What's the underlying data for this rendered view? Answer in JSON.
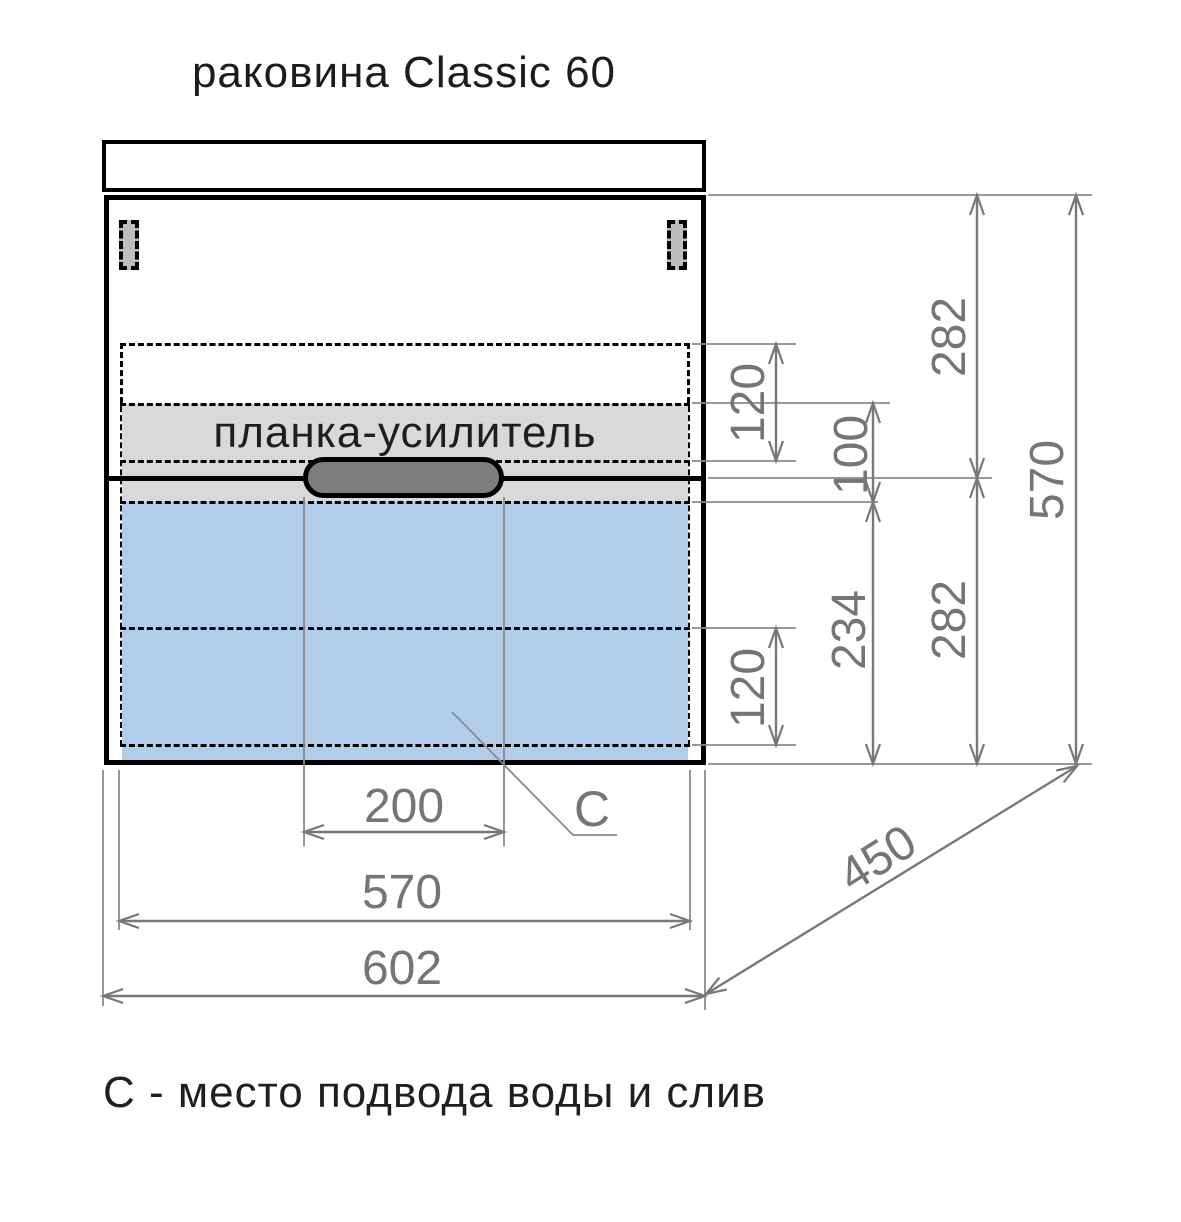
{
  "title": "раковина Classic 60",
  "caption": "С - место подвода воды и слив",
  "labels": {
    "reinforcement_bar": "планка-усилитель",
    "c_marker": "C"
  },
  "dimensions": {
    "overall_width": "602",
    "inner_width": "570",
    "handle_span": "200",
    "side_height": "570",
    "upper_section_height": "282",
    "lower_section_height": "282",
    "hole_top_offset": "120",
    "reinforcement_height": "100",
    "drawer_zone_height": "234",
    "hole_bottom_offset": "120",
    "depth": "450"
  },
  "colors": {
    "sink_area_fill": "#b2cde9",
    "reinforcement_fill": "#d9d9d9",
    "handle_fill": "#7d7d7d",
    "hinge_fill": "#bdbdbd",
    "dimension_gray": "#787878",
    "outline_black": "#000000"
  }
}
